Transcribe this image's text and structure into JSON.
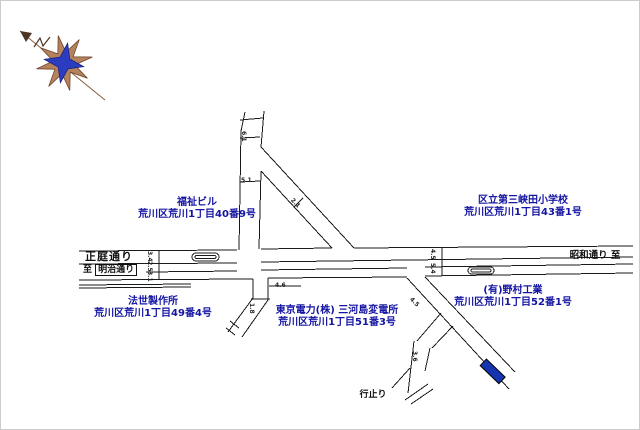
{
  "colors": {
    "background": "#ffffff",
    "road_line": "#1a1a1a",
    "label_blue": "#1515a3",
    "marker_blue": "#1535b0",
    "compass_blue": "#2b3cc0",
    "compass_tan": "#b5825e",
    "compass_line": "#8a5a3a"
  },
  "compass": {
    "type": "compass-rose",
    "north_arrow_direction": "upper-left"
  },
  "places": [
    {
      "name": "福祉ビル",
      "address": "荒川区荒川1丁目40番9号"
    },
    {
      "name": "区立第三峡田小学校",
      "address": "荒川区荒川1丁目43番1号"
    },
    {
      "name": "法世製作所",
      "address": "荒川区荒川1丁目49番4号"
    },
    {
      "name": "東京電力(株) 三河島変電所",
      "address": "荒川区荒川1丁目51番3号"
    },
    {
      "name": "(有)野村工業",
      "address": "荒川区荒川1丁目52番1号"
    }
  ],
  "roads": {
    "shotei_dori": "正庭通り",
    "to_prefix": "至",
    "meiji_dori": "明治通り",
    "showa_dori": "昭和通り 至",
    "dead_end": "行止り"
  },
  "dims": [
    {
      "text": "6.1"
    },
    {
      "text": "5.1"
    },
    {
      "text": "2.1"
    },
    {
      "text": "3.4"
    },
    {
      "text": "2.5"
    },
    {
      "text": "3.1"
    },
    {
      "text": "4.5"
    },
    {
      "text": "5.4"
    },
    {
      "text": "4.6"
    },
    {
      "text": "1.8"
    },
    {
      "text": "4.5"
    },
    {
      "text": "3.6"
    }
  ]
}
